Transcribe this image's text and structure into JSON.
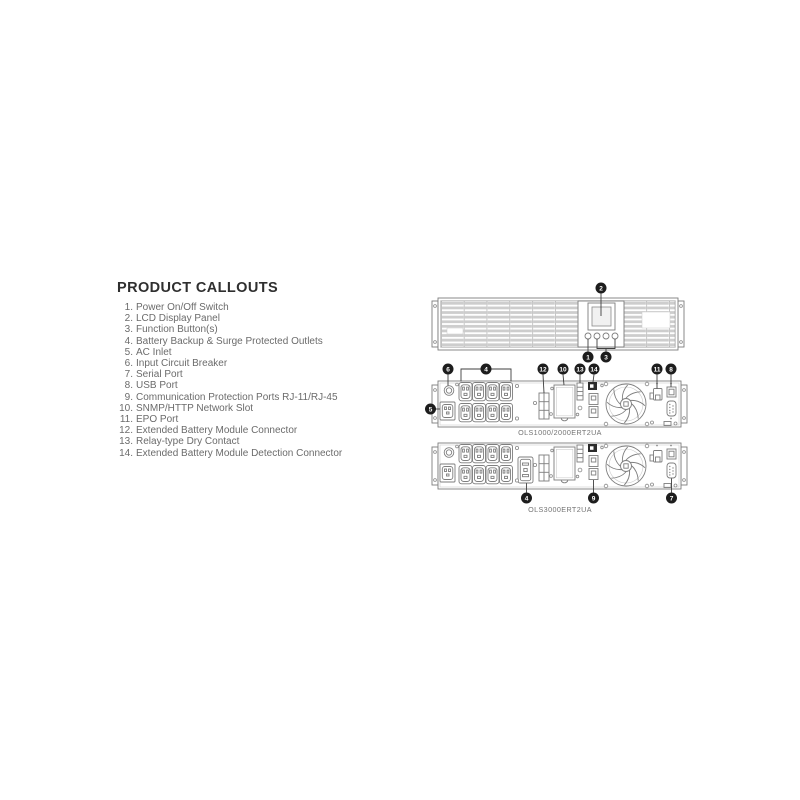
{
  "page": {
    "background": "#ffffff"
  },
  "colors": {
    "line_art": "#7e7e7e",
    "badge": "#1d1d1d",
    "title_text": "#2f2f2f",
    "body_text": "#6b6b6b",
    "vent_fill": "#cdcdcd"
  },
  "callouts": {
    "title": "PRODUCT CALLOUTS",
    "items": [
      {
        "number": "1.",
        "label": "Power On/Off Switch"
      },
      {
        "number": "2.",
        "label": "LCD Display Panel"
      },
      {
        "number": "3.",
        "label": "Function Button(s)"
      },
      {
        "number": "4.",
        "label": "Battery Backup & Surge Protected Outlets"
      },
      {
        "number": "5.",
        "label": "AC Inlet"
      },
      {
        "number": "6.",
        "label": "Input Circuit Breaker"
      },
      {
        "number": "7.",
        "label": "Serial Port"
      },
      {
        "number": "8.",
        "label": "USB Port"
      },
      {
        "number": "9.",
        "label": "Communication Protection Ports RJ-11/RJ-45"
      },
      {
        "number": "10.",
        "label": "SNMP/HTTP Network Slot"
      },
      {
        "number": "11.",
        "label": "EPO Port"
      },
      {
        "number": "12.",
        "label": "Extended Battery Module Connector"
      },
      {
        "number": "13.",
        "label": "Relay-type Dry Contact"
      },
      {
        "number": "14.",
        "label": "Extended Battery Module Detection Connector"
      }
    ]
  },
  "diagrams": {
    "front": {
      "badges": {
        "lcd": "2",
        "power_switch": "1",
        "function_buttons": "3"
      }
    },
    "rear1": {
      "model_label": "OLS1000/2000ERT2UA",
      "badges": {
        "ac_inlet": "5",
        "circuit_breaker": "6",
        "outlets": "4",
        "ebm_connector": "12",
        "network_slot": "10",
        "dry_contact": "13",
        "ebm_detection": "14",
        "epo_port": "11",
        "usb_port": "8"
      }
    },
    "rear2": {
      "model_label": "OLS3000ERT2UA",
      "badges": {
        "outlets": "4",
        "comm_ports": "9",
        "serial_port": "7"
      }
    }
  }
}
